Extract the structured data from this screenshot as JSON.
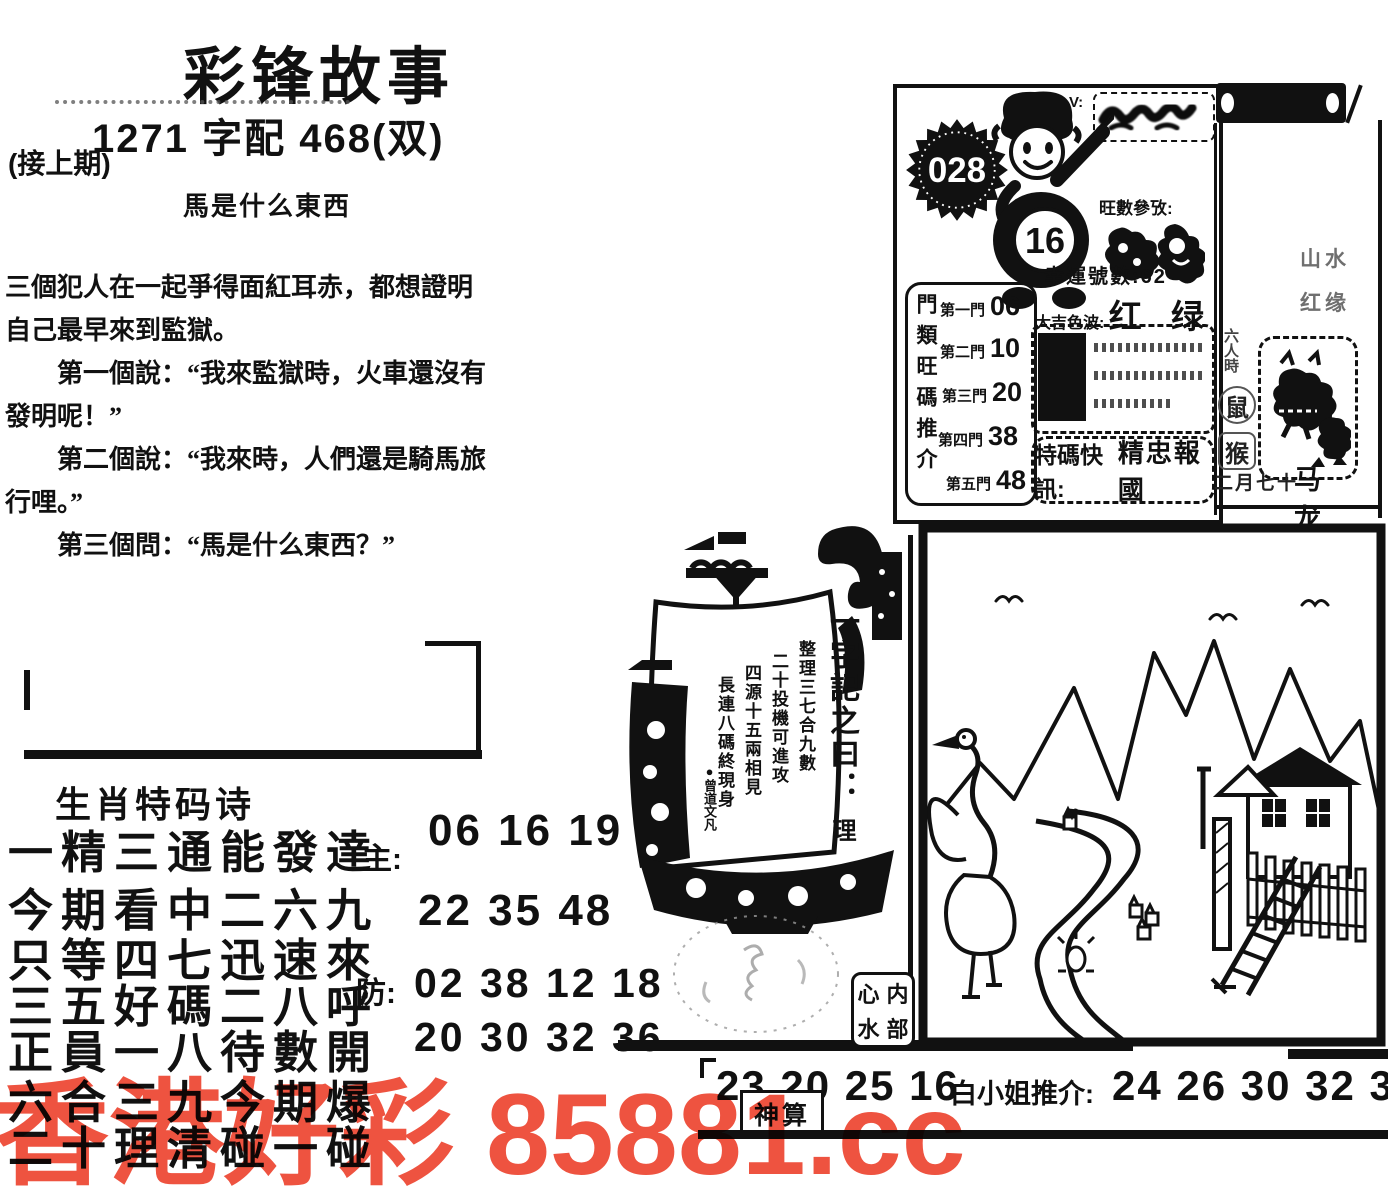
{
  "watermark": {
    "text": "香港好彩 85881.cc",
    "color": "#ee5340"
  },
  "header": {
    "title": "彩锋故事",
    "code_line": "1271 字配 468(双)",
    "continued": "(接上期)",
    "story_title": "馬是什么東西"
  },
  "story": {
    "p1": "三個犯人在一起爭得面紅耳赤，都想證明自己最早來到監獄。",
    "p2": "第一個說：“我來監獄時，火車還沒有發明呢！”",
    "p3": "第二個說：“我來時，人們還是騎馬旅行哩。”",
    "p4": "第三個問：“馬是什么東西？”"
  },
  "issue": {
    "badge_number": "028",
    "v_mark": "V:",
    "boy_number": "16",
    "hot_label": "旺數參攷:",
    "lucky_line": "幸運號數:62",
    "color_label": "大吉色波:",
    "color_value": "红 绿",
    "special_label": "特碼快訊:",
    "special_value": "精忠報國",
    "doors_vertical_label": "門類旺碼推介",
    "doors": [
      {
        "label": "第一門",
        "value": "06"
      },
      {
        "label": "第二門",
        "value": "10"
      },
      {
        "label": "第三門",
        "value": "20"
      },
      {
        "label": "第四門",
        "value": "38"
      },
      {
        "label": "第五門",
        "value": "48"
      }
    ]
  },
  "side": {
    "faint_1": "山水",
    "faint_2": "红缘",
    "vertical_label": "六人時",
    "zodiac_1": "鼠",
    "zodiac_2": "猴",
    "date_text": "二月七十",
    "animals_text": "马 龙"
  },
  "sail": {
    "headline": "一字記之曰：",
    "headline_char": "理",
    "line1": "整理三七合九數",
    "line2": "二十投機可進攻",
    "line3": "四源十五兩相見",
    "line4": "長連八碼終現身",
    "signature": "●曾道文凡"
  },
  "seal_box": {
    "c1": "心",
    "c2": "内",
    "c3": "水",
    "c4": "部"
  },
  "poem": {
    "heading": "生肖特码诗",
    "line1": "一精三通能發達",
    "line2": "今期看中二六九",
    "line3": "只等四七迅速來",
    "line4": "三五好碼二八呼",
    "line5": "正員一八待數開",
    "line6": "六合三九今期爆",
    "line7": "二十理清碰一碰",
    "main_label": "主:",
    "main_row1": "06 16 19",
    "main_row2": "22 35 48",
    "guard_label": "防:",
    "guard_row1": "02 38 12 18",
    "guard_row2": "20 30 32 36"
  },
  "bottom": {
    "numbers": "23 20 25 16",
    "recommend_label": "白小姐推介:",
    "recommend_numbers": "24 26 30 32 36",
    "badge": "神算"
  }
}
